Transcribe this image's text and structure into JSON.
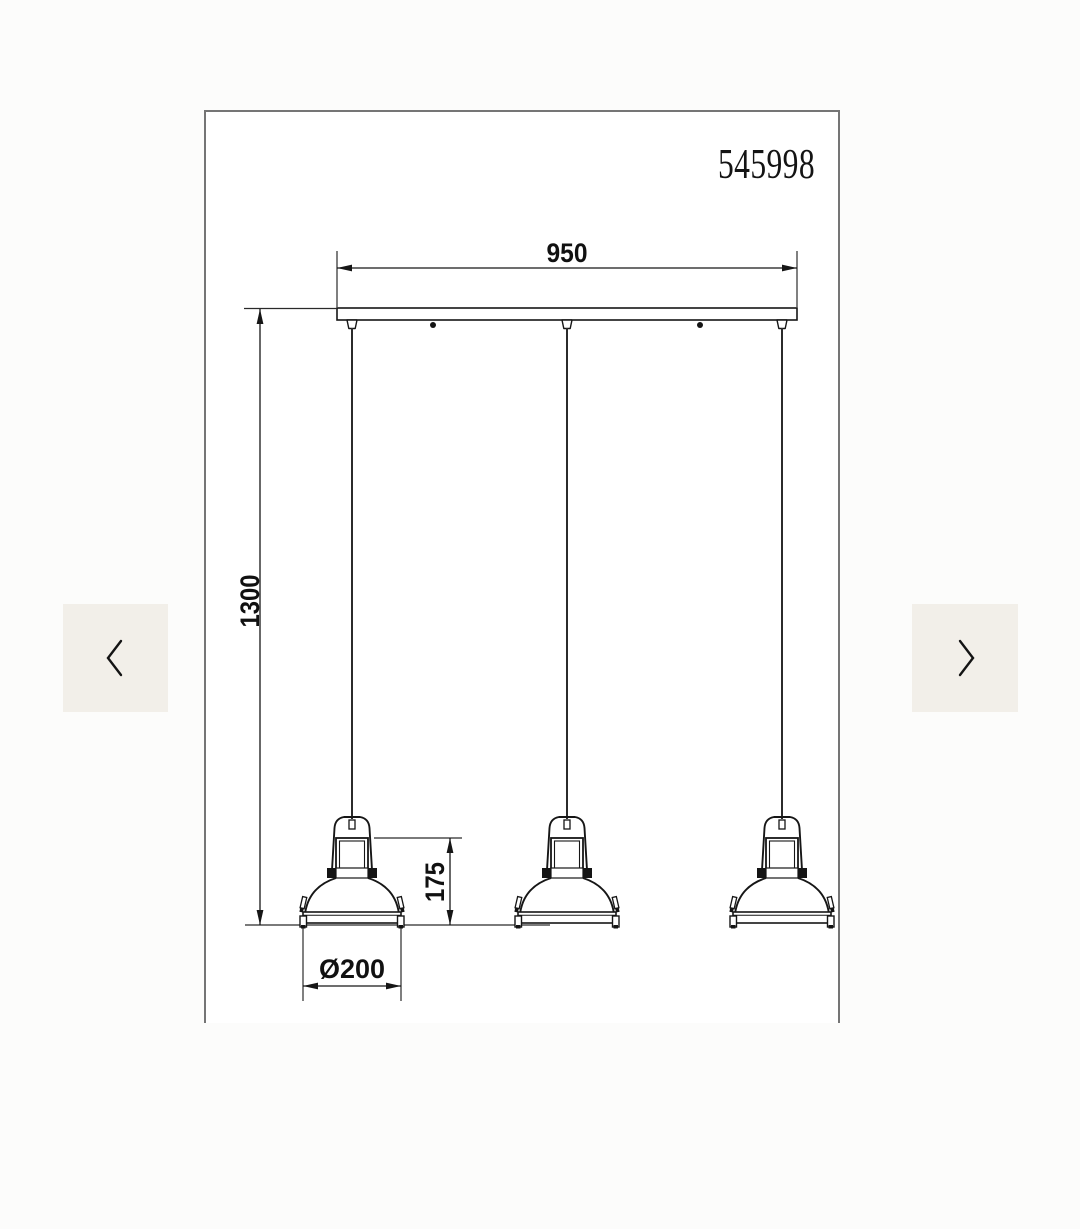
{
  "page": {
    "background": "#fcfcfb"
  },
  "carousel": {
    "prev_icon": "chevron-left",
    "next_icon": "chevron-right",
    "button_bg": "#f2efe9"
  },
  "drawing": {
    "product_number": "545998",
    "lamp_count": 3,
    "dimensions": {
      "track_width": {
        "label": "950"
      },
      "drop_height": {
        "label": "1300"
      },
      "shade_height": {
        "label": "175"
      },
      "shade_diameter": {
        "label": "Ø200"
      }
    },
    "colors": {
      "line": "#161616",
      "frame_border": "#757575",
      "canvas": "#ffffff"
    }
  }
}
